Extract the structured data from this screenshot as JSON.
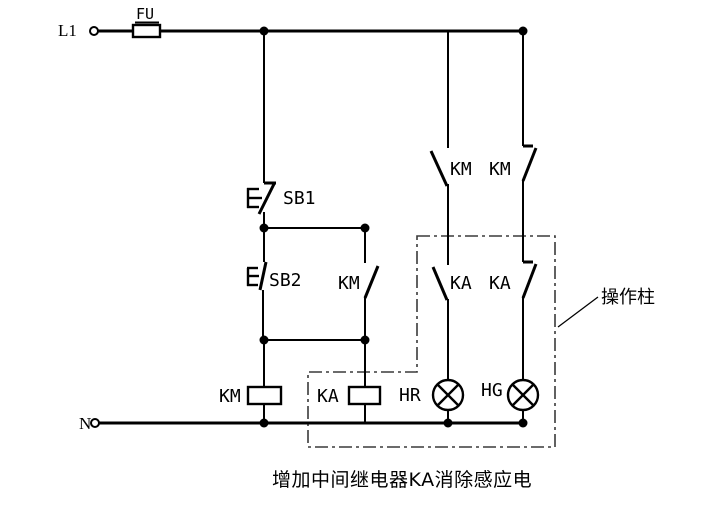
{
  "colors": {
    "line": "#000000",
    "background": "#ffffff",
    "enclosure_line": "#3a3a3a"
  },
  "power": {
    "phase_label": "L1",
    "neutral_label": "N"
  },
  "components": {
    "fuse_label": "FU",
    "stop_button_label": "SB1",
    "start_button_label": "SB2",
    "km_seal_in_contact_label": "KM",
    "km_no_contact_label": "KM",
    "km_nc_contact_label": "KM",
    "ka_no_contact_label": "KA",
    "ka_nc_contact_label": "KA",
    "km_coil_label": "KM",
    "ka_coil_label": "KA",
    "red_lamp_label": "HR",
    "green_lamp_label": "HG"
  },
  "enclosure": {
    "label": "操作柱"
  },
  "caption": "增加中间继电器KA消除感应电"
}
